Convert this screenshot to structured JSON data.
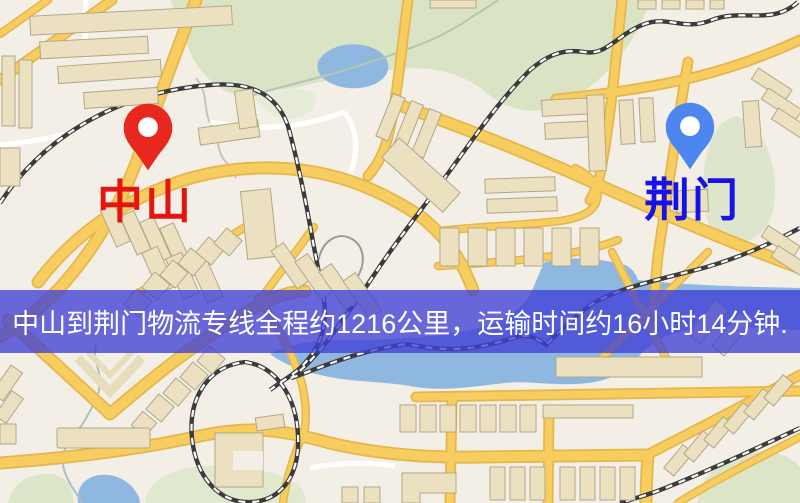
{
  "banner": {
    "text": "中山到荆门物流专线全程约1216公里，运输时间约16小时14分钟.",
    "background": "rgba(64,64,214,0.78)",
    "text_color": "#ffffff"
  },
  "markers": {
    "origin": {
      "label": "中山",
      "pin_icon": "red-map-pin",
      "pin_color": "#e8281e",
      "label_color": "#e41410"
    },
    "destination": {
      "label": "荆门",
      "pin_icon": "blue-map-pin",
      "pin_color": "#4d86ee",
      "label_color": "#1712e6"
    }
  },
  "map": {
    "background": "#f3efe6",
    "road_color": "#f6cd5e",
    "road_casing": "#e5b64e",
    "park_color": "#dae3c3",
    "park_color_light": "#e4ebd4",
    "water_color": "#8fb8e0",
    "railway_color": "#3b3b3b",
    "building_color": "#ebe1c1",
    "stream_color": "#aebdc6"
  }
}
